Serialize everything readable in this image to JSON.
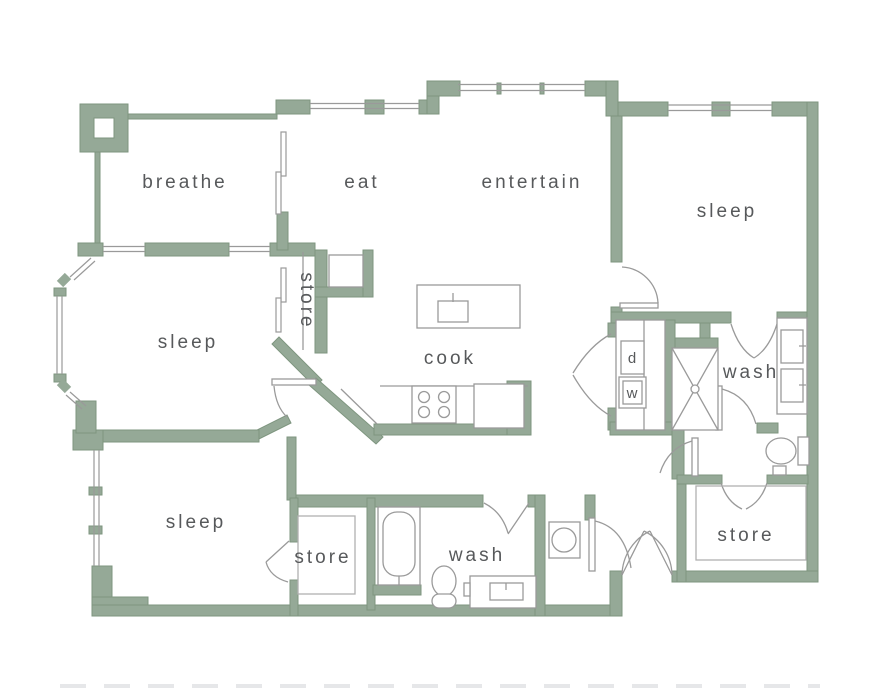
{
  "title": "apartment floor plan",
  "colors": {
    "wall_fill": "#95a997",
    "wall_stroke": "#7e957f",
    "fixture_line": "#9a9a9a",
    "label_text": "#57595b",
    "background": "#ffffff"
  },
  "rooms": {
    "balcony": "breathe",
    "dining": "eat",
    "living": "entertain",
    "bedroom_top_right": "sleep",
    "bedroom_left": "sleep",
    "closet_pantry": "store",
    "kitchen": "cook",
    "bath_master": "wash",
    "dryer": "d",
    "washer": "w",
    "bedroom_bottom": "sleep",
    "closet_bottom": "store",
    "bath_bottom": "wash",
    "storage_bottom_right": "store"
  }
}
